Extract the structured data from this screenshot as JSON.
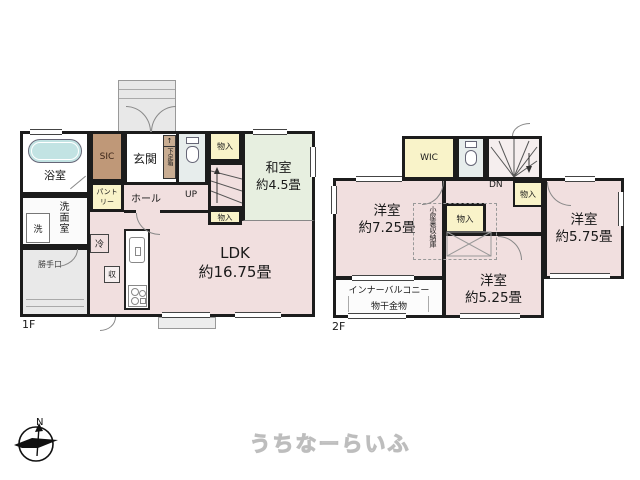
{
  "floor1": {
    "label": "1F",
    "bath": "浴室",
    "washroom": "洗面室",
    "laundry": "洗",
    "back_door": "勝手口",
    "sic": "SIC",
    "pantry": "パントリー",
    "entrance": "玄関",
    "shoe_box": "下足箱",
    "step_mark": "↑",
    "hall": "ホール",
    "up": "UP",
    "storage_top": "物入",
    "storage_bottom": "物入",
    "washitsu_name": "和室",
    "washitsu_size": "約4.5畳",
    "ldk_name": "LDK",
    "ldk_size": "約16.75畳",
    "fridge": "冷",
    "storage_small": "収"
  },
  "floor2": {
    "label": "2F",
    "wic": "WIC",
    "dn": "DN",
    "storage_top": "物入",
    "storage_mid": "物入",
    "attic": "小屋裏収納庫",
    "west_name": "洋室",
    "west_size": "約7.25畳",
    "east_name": "洋室",
    "east_size": "約5.75畳",
    "south_name": "洋室",
    "south_size": "約5.25畳",
    "balcony": "インナーバルコニー",
    "hanger": "物干金物"
  },
  "compass": {
    "north": "N"
  },
  "logo": {
    "text": "うちなーらいふ"
  },
  "colors": {
    "room_pink": "#f1dfdf",
    "tatami_green": "#e7efe0",
    "storage_yellow": "#f9f3c9",
    "sic_brown": "#bf9878",
    "shoebox_tan": "#c9ad92",
    "toilet_blue": "#e7edec",
    "tub_teal": "#c2e3e3",
    "porch_gray": "#e8e8e8",
    "wall": "#1c1c1c"
  }
}
